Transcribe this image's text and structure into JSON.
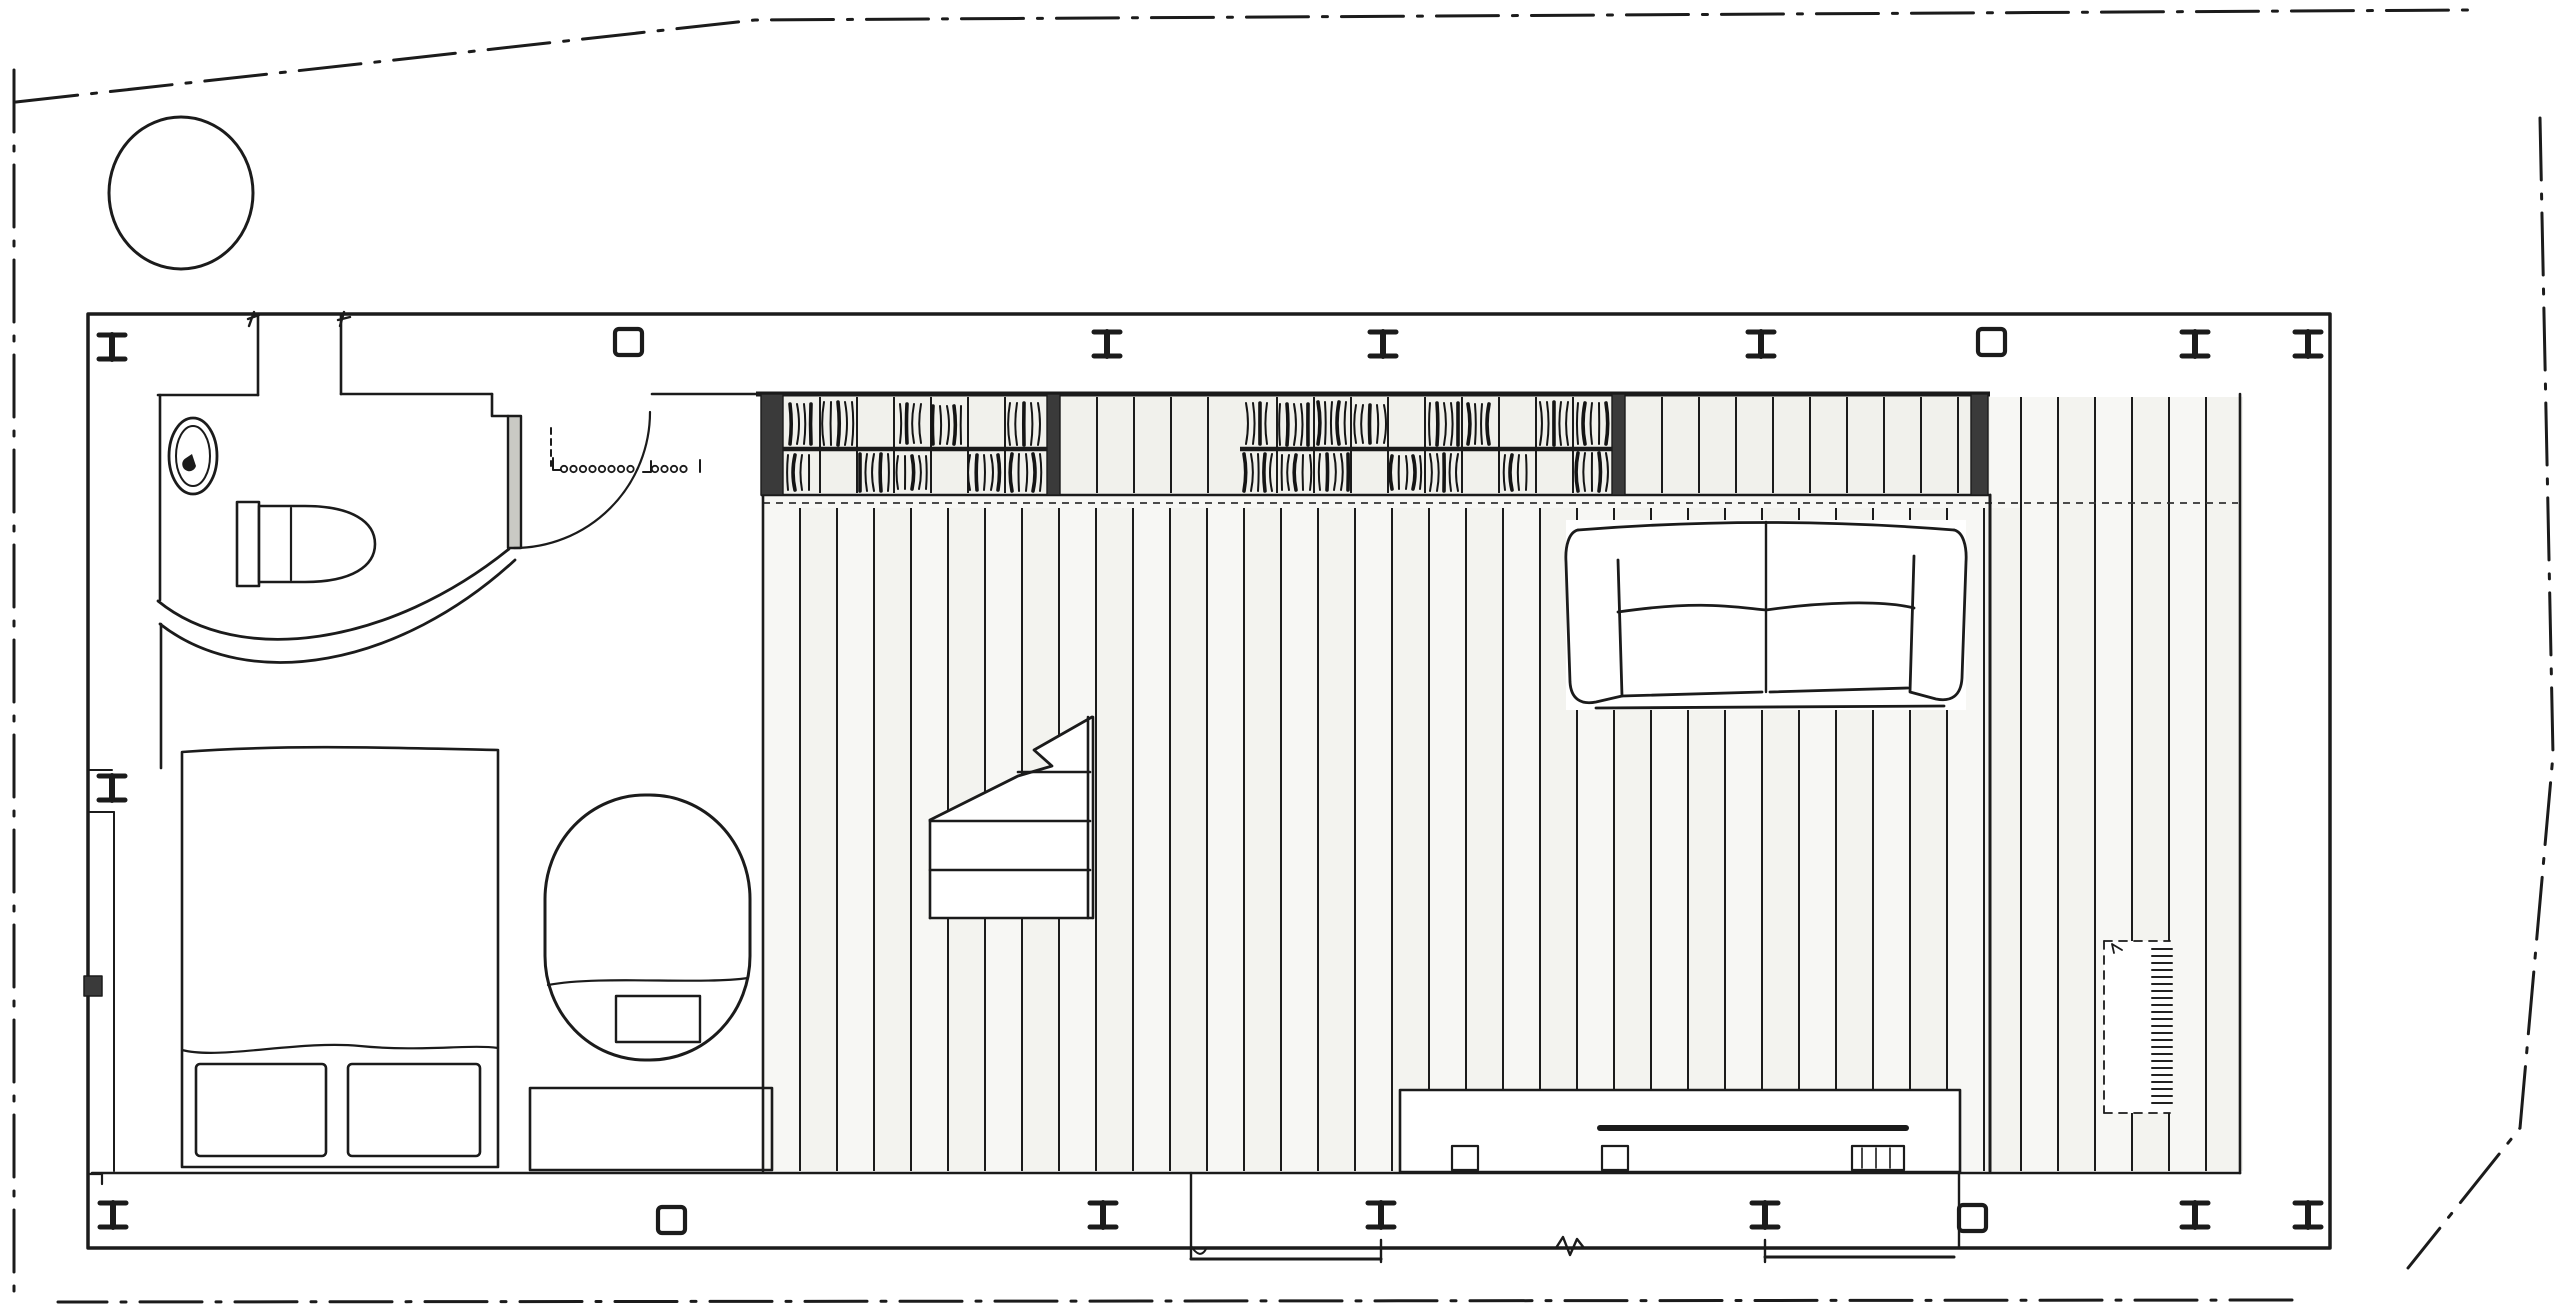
{
  "meta": {
    "kind": "hand-drawn architectural floor plan",
    "description": "Single-storey dwelling plan: bathroom and bedroom at left, central staircase, long bookshelf wall, sofa and decked terrace at right, dash-dot property boundary with tree symbol"
  },
  "canvas": {
    "w": 2560,
    "h": 1308
  },
  "colors": {
    "ink": "#1b1b1b",
    "soft_ink": "#333333",
    "paper": "#ffffff",
    "deck_fill": "#f7f7f4",
    "plank_alt_fill": "#f3f3ef",
    "shelf_fill": "#f1f1ec",
    "dark_cap": "#3a3a3a",
    "door_leaf": "#c9c9c4"
  },
  "boundary": {
    "stroke_width": 3,
    "dash": "62 14 5 14",
    "segments": [
      [
        [
          14,
          70
        ],
        [
          14,
          1302
        ]
      ],
      [
        [
          16,
          102
        ],
        [
          755,
          20
        ],
        [
          2468,
          10
        ]
      ],
      [
        [
          2540,
          118
        ],
        [
          2553,
          755
        ],
        [
          2520,
          1128
        ],
        [
          2408,
          1268
        ]
      ],
      [
        [
          2292,
          1300
        ],
        [
          58,
          1302
        ]
      ]
    ]
  },
  "tree": {
    "cx": 181,
    "cy": 193,
    "rx": 72,
    "ry": 76
  },
  "building": {
    "x0": 88,
    "y0": 314,
    "x1": 2330,
    "y1": 1248,
    "floor_y": 1173,
    "ceil_y": 394,
    "right_inner_x": 2240
  },
  "planks": {
    "x0": 800,
    "x1": 2223,
    "step": 37,
    "split_x": 1990,
    "y_top_left": 508,
    "y_top_right": 397,
    "y_bottom": 1171,
    "left_edge_x": 763
  },
  "shelf": {
    "x0": 761,
    "x1": 1990,
    "y0": 394,
    "y1": 495,
    "mid_y": 449,
    "dash_y": 503,
    "divider_step": 37,
    "caps": [
      [
        761,
        783
      ],
      [
        1047,
        1060
      ],
      [
        1612,
        1625
      ],
      [
        1971,
        1988
      ]
    ],
    "units": [
      [
        783,
        1047
      ],
      [
        1060,
        1235
      ],
      [
        1240,
        1612
      ],
      [
        1625,
        1971
      ]
    ],
    "mid_units": [
      [
        783,
        1047
      ],
      [
        1240,
        1612
      ]
    ]
  },
  "books": {
    "rows": [
      {
        "x0": 790,
        "x1": 815,
        "y0": 404,
        "y1": 444
      },
      {
        "x0": 824,
        "x1": 854,
        "y0": 402,
        "y1": 445
      },
      {
        "x0": 900,
        "x1": 926,
        "y0": 404,
        "y1": 443
      },
      {
        "x0": 933,
        "x1": 964,
        "y0": 406,
        "y1": 444
      },
      {
        "x0": 1010,
        "x1": 1040,
        "y0": 403,
        "y1": 445
      },
      {
        "x0": 788,
        "x1": 814,
        "y0": 455,
        "y1": 490
      },
      {
        "x0": 860,
        "x1": 890,
        "y0": 454,
        "y1": 491
      },
      {
        "x0": 898,
        "x1": 926,
        "y0": 456,
        "y1": 489
      },
      {
        "x0": 970,
        "x1": 1000,
        "y0": 455,
        "y1": 490
      },
      {
        "x0": 1012,
        "x1": 1044,
        "y0": 454,
        "y1": 491
      },
      {
        "x0": 1246,
        "x1": 1272,
        "y0": 403,
        "y1": 444
      },
      {
        "x0": 1280,
        "x1": 1310,
        "y0": 404,
        "y1": 445
      },
      {
        "x0": 1318,
        "x1": 1348,
        "y0": 402,
        "y1": 444
      },
      {
        "x0": 1356,
        "x1": 1384,
        "y0": 405,
        "y1": 443
      },
      {
        "x0": 1430,
        "x1": 1458,
        "y0": 403,
        "y1": 445
      },
      {
        "x0": 1468,
        "x1": 1494,
        "y0": 404,
        "y1": 444
      },
      {
        "x0": 1540,
        "x1": 1570,
        "y0": 402,
        "y1": 445
      },
      {
        "x0": 1578,
        "x1": 1606,
        "y0": 403,
        "y1": 444
      },
      {
        "x0": 1244,
        "x1": 1274,
        "y0": 454,
        "y1": 491
      },
      {
        "x0": 1282,
        "x1": 1312,
        "y0": 455,
        "y1": 490
      },
      {
        "x0": 1320,
        "x1": 1350,
        "y0": 454,
        "y1": 490
      },
      {
        "x0": 1392,
        "x1": 1420,
        "y0": 456,
        "y1": 489
      },
      {
        "x0": 1430,
        "x1": 1460,
        "y0": 454,
        "y1": 491
      },
      {
        "x0": 1505,
        "x1": 1532,
        "y0": 455,
        "y1": 490
      },
      {
        "x0": 1578,
        "x1": 1608,
        "y0": 453,
        "y1": 491
      }
    ],
    "stroke_step": 7
  },
  "columns": {
    "i_top": [
      {
        "x": 112,
        "y": 347
      },
      {
        "x": 1107,
        "y": 344
      },
      {
        "x": 1383,
        "y": 344
      },
      {
        "x": 1761,
        "y": 344
      },
      {
        "x": 2195,
        "y": 344
      },
      {
        "x": 2308,
        "y": 344
      }
    ],
    "sq_top": [
      {
        "x": 629,
        "y": 342
      },
      {
        "x": 1992,
        "y": 342
      }
    ],
    "i_bottom": [
      {
        "x": 113,
        "y": 1215
      },
      {
        "x": 1103,
        "y": 1215
      },
      {
        "x": 1381,
        "y": 1215
      },
      {
        "x": 1765,
        "y": 1215
      },
      {
        "x": 2195,
        "y": 1215
      },
      {
        "x": 2308,
        "y": 1215
      }
    ],
    "sq_bottom": [
      {
        "x": 672,
        "y": 1220
      },
      {
        "x": 1973,
        "y": 1218
      }
    ],
    "i_left": [
      {
        "x": 112,
        "y": 788
      }
    ]
  },
  "threshold": {
    "dot_y": 469,
    "dot_r": 3.2,
    "groups": [
      {
        "x0": 564,
        "n": 8,
        "step": 9.5
      },
      {
        "x0": 655,
        "n": 4,
        "step": 9.5
      }
    ],
    "riser_x": 551,
    "riser_y0": 428,
    "riser_y1": 466
  },
  "mat": {
    "x": 2104,
    "y": 941,
    "w": 66,
    "h": 172,
    "hatch_step": 7
  }
}
